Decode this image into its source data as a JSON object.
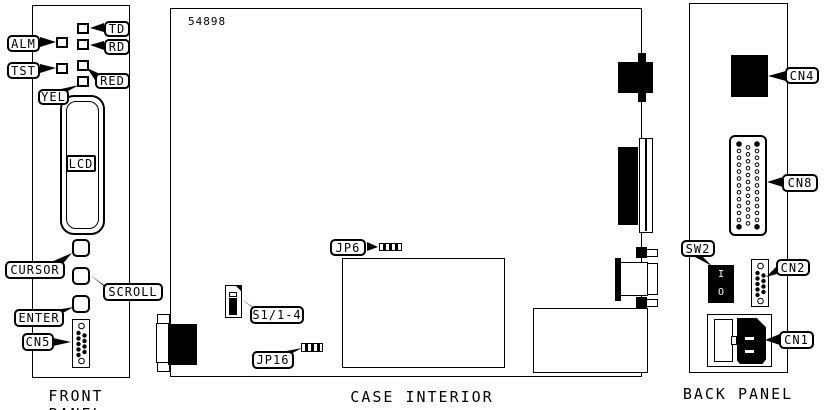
{
  "diagram": {
    "figure_number": "54898",
    "colors": {
      "ink": "#000000",
      "paper": "#ffffff"
    }
  },
  "front_panel": {
    "title": "FRONT PANEL",
    "callouts": {
      "alm": "ALM",
      "tst": "TST",
      "td": "TD",
      "rd": "RD",
      "red": "RED",
      "yel": "YEL",
      "lcd": "LCD",
      "cursor": "CURSOR",
      "scroll": "SCROLL",
      "enter": "ENTER",
      "cn5": "CN5"
    }
  },
  "case_interior": {
    "title": "CASE INTERIOR",
    "callouts": {
      "jp6": "JP6",
      "s1": "S1/1-4",
      "jp16": "JP16"
    }
  },
  "back_panel": {
    "title": "BACK PANEL",
    "callouts": {
      "cn4": "CN4",
      "cn8": "CN8",
      "sw2": "SW2",
      "cn2": "CN2",
      "cn1": "CN1"
    },
    "switch_markings": {
      "on": "I",
      "off": "O"
    }
  }
}
